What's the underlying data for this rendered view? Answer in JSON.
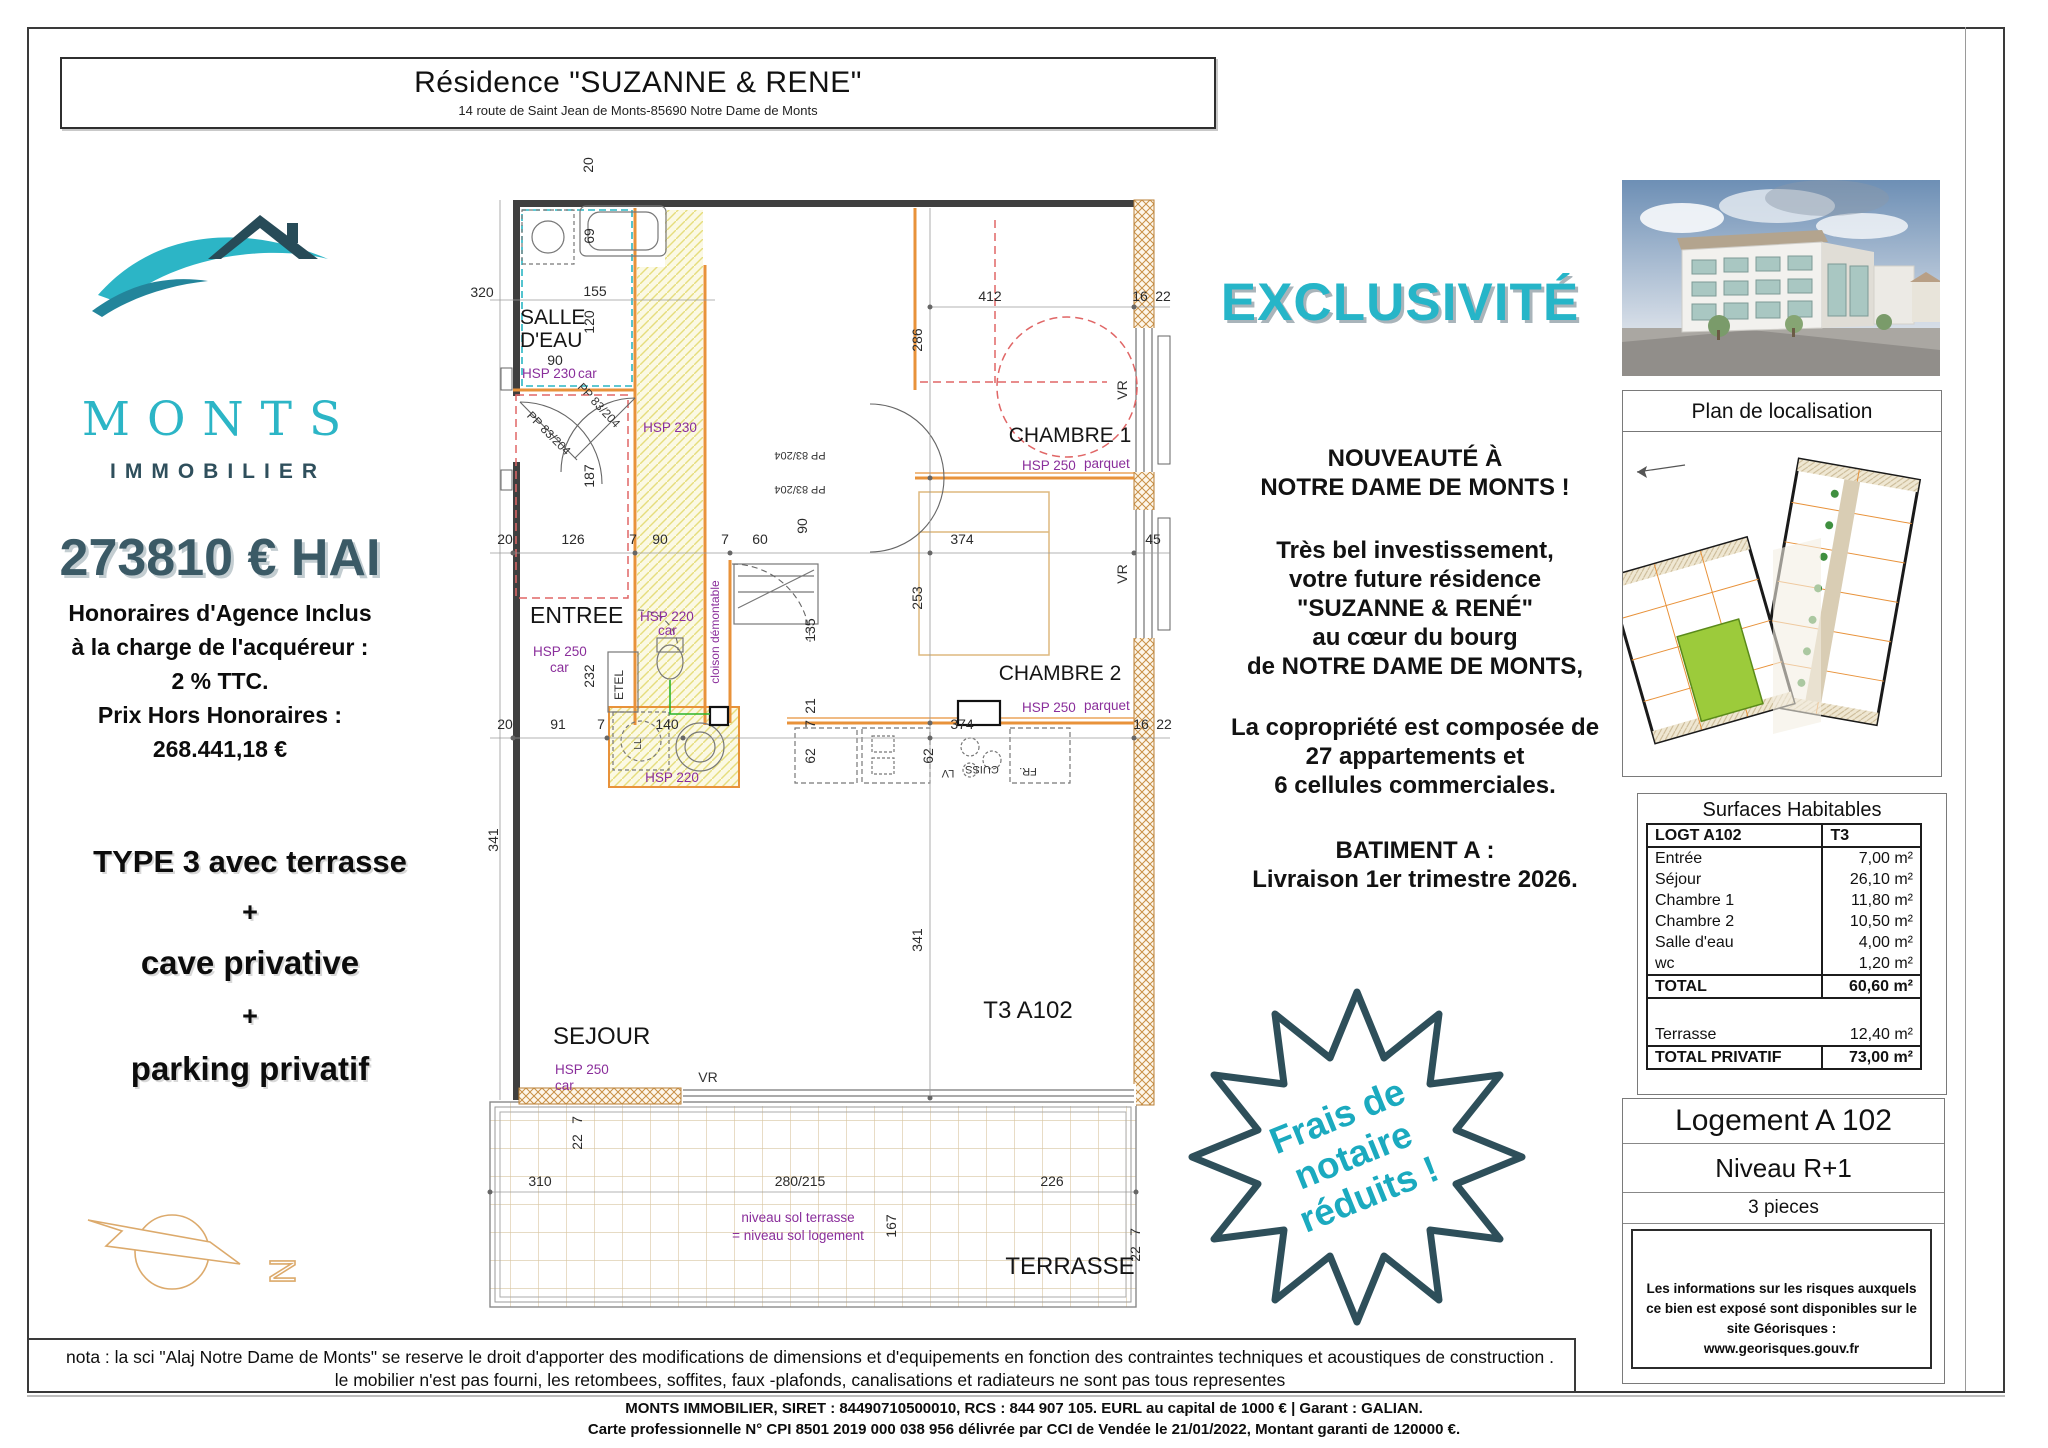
{
  "header": {
    "title": "Résidence \"SUZANNE & RENE\"",
    "address": "14 route de Saint Jean de Monts-85690 Notre Dame de Monts"
  },
  "brand": {
    "name": "MONTS",
    "subtitle": "IMMOBILIER"
  },
  "pricing": {
    "amount": "273810 € HAI",
    "lines": [
      "Honoraires d'Agence Inclus",
      "à la charge de l'acquéreur :",
      "2 % TTC.",
      "Prix Hors Honoraires :",
      "268.441,18 €"
    ]
  },
  "offer": {
    "lines": [
      "TYPE 3 avec terrasse",
      "+",
      "cave privative",
      "+",
      "parking privatif"
    ]
  },
  "exclusivity_label": "EXCLUSIVITÉ",
  "promo": {
    "p1": [
      "NOUVEAUTÉ À",
      "NOTRE DAME DE MONTS !"
    ],
    "p2": [
      "Très bel investissement,",
      "votre future résidence",
      "\"SUZANNE & RENÉ\"",
      "au cœur du bourg",
      "de NOTRE DAME DE MONTS,"
    ],
    "p3": [
      "La copropriété est composée de",
      "27 appartements et",
      "6 cellules commerciales."
    ],
    "p4": [
      "BATIMENT A :",
      "Livraison 1er trimestre 2026."
    ]
  },
  "badge": {
    "lines": [
      "Frais de",
      "notaire",
      "réduits !"
    ]
  },
  "localisation": {
    "title": "Plan de localisation"
  },
  "surfaces": {
    "title": "Surfaces Habitables",
    "columns": [
      "LOGT A102",
      "T3"
    ],
    "rows": [
      [
        "Entrée",
        "7,00 m²"
      ],
      [
        "Séjour",
        "26,10 m²"
      ],
      [
        "Chambre 1",
        "11,80 m²"
      ],
      [
        "Chambre 2",
        "10,50 m²"
      ],
      [
        "Salle d'eau",
        "4,00 m²"
      ],
      [
        "wc",
        "1,20 m²"
      ]
    ],
    "total": [
      "TOTAL",
      "60,60 m²"
    ],
    "terrasse": [
      "Terrasse",
      "12,40 m²"
    ],
    "total_privatif": [
      "TOTAL PRIVATIF",
      "73,00 m²"
    ]
  },
  "unit": {
    "name": "Logement A 102",
    "level": "Niveau R+1",
    "rooms": "3 pieces",
    "risk_lines": [
      "Les informations sur les risques auxquels",
      "ce bien est exposé sont disponibles sur le site Géorisques :",
      "www.georisques.gouv.fr"
    ]
  },
  "compass": {
    "n": "N"
  },
  "plan": {
    "rooms": {
      "salle1": "SALLE",
      "salle2": "D'EAU",
      "entree": "ENTREE",
      "sejour": "SEJOUR",
      "chambre1": "CHAMBRE 1",
      "chambre2": "CHAMBRE 2",
      "terrasse": "TERRASSE",
      "unit": "T3 A102"
    },
    "ann": {
      "hsp230": "HSP 230",
      "hsp250": "HSP 250",
      "hsp220": "HSP 220",
      "car": "car",
      "parquet": "parquet",
      "cloison": "cloison démontable",
      "niveau1": "niveau sol terrasse",
      "niveau2": "= niveau sol logement",
      "pp": "PP 83/204",
      "etel": "ETEL",
      "vr": "VR",
      "lv": "LV",
      "cuiss": "CUISS",
      "fr": "FR.",
      "ll": "LL"
    },
    "dims": {
      "7": "7",
      "16": "16",
      "20": "20",
      "21": "21",
      "22": "22",
      "45": "45",
      "60": "60",
      "62": "62",
      "69": "69",
      "90": "90",
      "91": "91",
      "120": "120",
      "126": "126",
      "135": "135",
      "140": "140",
      "155": "155",
      "167": "167",
      "187": "187",
      "226": "226",
      "232": "232",
      "253": "253",
      "280_215": "280/215",
      "286": "286",
      "310": "310",
      "320": "320",
      "341": "341",
      "374": "374",
      "412": "412"
    }
  },
  "footer": {
    "nota": [
      "nota : la sci \"Alaj Notre Dame de Monts\" se reserve le droit d'apporter des modifications de dimensions et d'equipements en fonction des contraintes techniques et acoustiques de construction .",
      "le mobilier n'est pas fourni, les retombees, soffites, faux -plafonds, canalisations et  radiateurs ne sont pas tous representes"
    ],
    "company": [
      "MONTS IMMOBILIER, SIRET : 84490710500010, RCS : 844 907 105. EURL au capital de 1000 € | Garant : GALIAN.",
      "Carte professionnelle N° CPI 8501 2019 000 038 956 délivrée par CCI de Vendée le 21/01/2022, Montant garanti de 120000 €."
    ]
  },
  "colors": {
    "cyan": "#26b5c8",
    "dark_teal": "#34555f",
    "purple": "#8a2e9b",
    "orange": "#e8923a",
    "green_unit": "#9ccb3b"
  }
}
